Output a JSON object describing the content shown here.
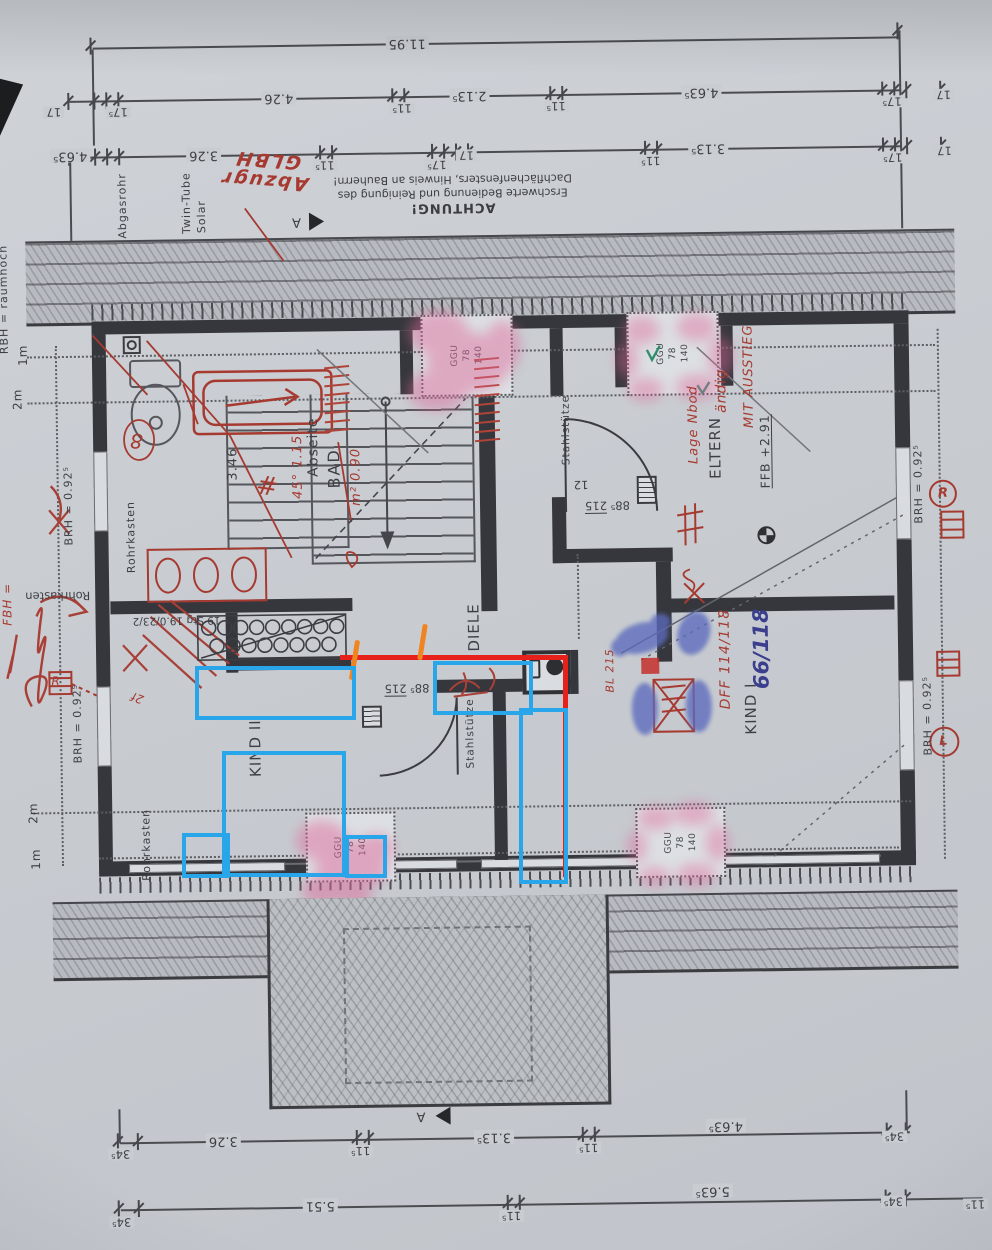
{
  "dims": {
    "overall": "11.95",
    "row_b": [
      "17",
      "17⁵",
      "4.26",
      "11⁵",
      "2.13⁵",
      "11⁵",
      "4.63⁵",
      "17⁵",
      "17"
    ],
    "row_c": [
      "4.63⁵",
      "3.26",
      "11⁵",
      "17⁵",
      "17",
      "11⁵",
      "3.13⁵",
      "17⁵",
      "17"
    ],
    "bottom_1": [
      "34⁵",
      "3.26",
      "11⁵",
      "3.13⁵",
      "11⁵",
      "4.63⁵",
      "34⁵"
    ],
    "bottom_2": [
      "34⁵",
      "5.51",
      "11⁵",
      "5.63⁵",
      "34⁵",
      "11⁵"
    ]
  },
  "note": {
    "title": "ACHTUNG!",
    "line1": "Erschwerte Bedienung und Reinigung des",
    "line2": "Dachflächenfensters, Hinweis an Bauherrn!"
  },
  "labels": {
    "abgasrohr": "Abgasrohr",
    "twin_tube": "Twin-Tube",
    "solar": "Solar",
    "rbh": "RBH = raumhoch",
    "rohrkasten": "Rohrkasten",
    "stahlstuetze": "Stahlstütze",
    "abseite": "Abseite",
    "bad": "BAD",
    "bad_width": "3.46",
    "diele": "DIELE",
    "eltern": "ELTERN",
    "kind1": "KIND I",
    "kind2": "KIND II",
    "ffb": "FFB +2.91",
    "brh": "BRH = 0.92⁵",
    "door_w": "88⁵",
    "door_h": "215",
    "stairs_line1": "19 Stg",
    "stairs_line2": "19.0/23/2",
    "stair_no": "12",
    "ggu1": "GGU",
    "ggu2": "78",
    "ggu3": "140",
    "h1": "1m",
    "h2": "2m",
    "section": "A"
  },
  "handwriting": {
    "top1": "Abzugr",
    "top2": "GLBH",
    "hash": "#",
    "circle8": "8",
    "note45": "45° 1.15",
    "note090": "m² 0.90",
    "eltern1": "Lage Nbod",
    "eltern2": "ändig",
    "eltern3": "MIT AUSSTIEG",
    "dff": "DFF 114/118",
    "kind1_size": "66/118",
    "bl": "BL 215",
    "fbh": "FBH =",
    "win_r": "R",
    "win_l": "L",
    "stairs": "2f"
  },
  "colors": {
    "digital_red": "#e6211b",
    "digital_blue": "#29a5ea",
    "digital_orange": "#f08420",
    "pink_highlight": "#e0679a",
    "blue_marker": "#5b6bbd",
    "red_ink": "#a63a30",
    "blue_ink": "#3a3e8c"
  }
}
